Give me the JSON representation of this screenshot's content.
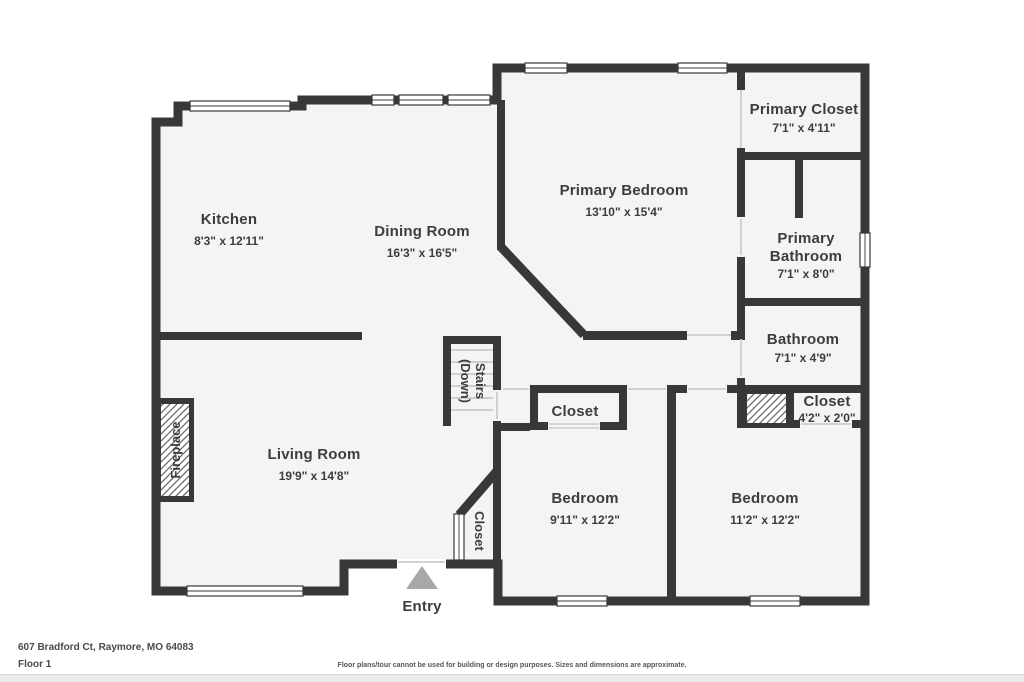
{
  "colors": {
    "wall": "#383838",
    "floor": "#f4f4f4",
    "label": "#3d3d3d",
    "entry_arrow": "#a8a8a8",
    "door_line": "#cccccc",
    "step_line": "#c0c0c0"
  },
  "rooms": {
    "kitchen": {
      "name": "Kitchen",
      "dims": "8'3\" x 12'11\""
    },
    "dining_room": {
      "name": "Dining Room",
      "dims": "16'3\" x 16'5\""
    },
    "primary_bedroom": {
      "name": "Primary Bedroom",
      "dims": "13'10\" x 15'4\""
    },
    "primary_closet": {
      "name": "Primary Closet",
      "dims": "7'1\" x 4'11\""
    },
    "primary_bathroom": {
      "name_line1": "Primary",
      "name_line2": "Bathroom",
      "dims": "7'1\" x 8'0\""
    },
    "bathroom": {
      "name": "Bathroom",
      "dims": "7'1\" x 4'9\""
    },
    "hall_closet": {
      "name": "Closet",
      "dims": "4'2\" x 2'0\""
    },
    "bedroom_small": {
      "name": "Bedroom",
      "dims": "9'11\" x 12'2\""
    },
    "bedroom_large": {
      "name": "Bedroom",
      "dims": "11'2\" x 12'2\""
    },
    "living_room": {
      "name": "Living Room",
      "dims": "19'9\" x 14'8\""
    },
    "bedroom_closet": {
      "name": "Closet"
    },
    "entry_closet": {
      "name": "Closet"
    },
    "stairs": {
      "line1": "Stairs",
      "line2": "(Down)"
    },
    "fireplace": {
      "name": "Fireplace"
    },
    "entry": {
      "name": "Entry"
    }
  },
  "footer": {
    "address": "607 Bradford Ct, Raymore, MO 64083",
    "floor": "Floor 1",
    "disclaimer": "Floor plans/tour cannot be used for building or design purposes. Sizes and dimensions are approximate."
  }
}
